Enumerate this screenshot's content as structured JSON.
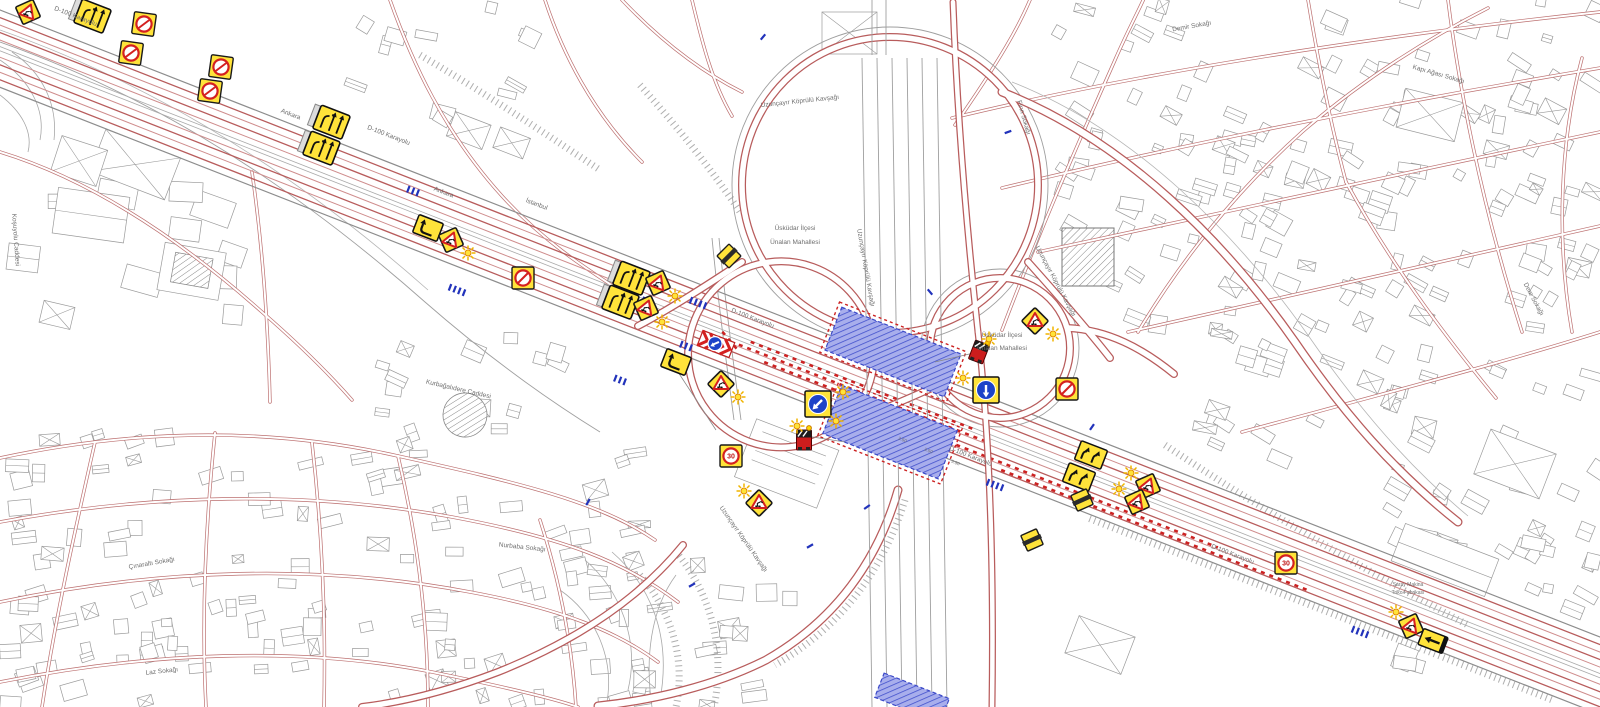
{
  "map": {
    "colors": {
      "sign_yellow": "#ffe33a",
      "work_zone_blue": "#8e97e8",
      "cone_red": "#cc2222",
      "road_red": "#b85c5c",
      "mandatory_blue": "#1d43c8",
      "building_gray": "#9a9a9a"
    },
    "labels": [
      {
        "text": "D-100 Karayolu",
        "x": 75,
        "y": 18,
        "r": 21
      },
      {
        "text": "Ankara",
        "x": 290,
        "y": 116,
        "r": 21
      },
      {
        "text": "D-100 Karayolu",
        "x": 388,
        "y": 137,
        "r": 21
      },
      {
        "text": "Ankara",
        "x": 443,
        "y": 194,
        "r": 21
      },
      {
        "text": "İstanbul",
        "x": 536,
        "y": 206,
        "r": 21
      },
      {
        "text": "D-100 Karayolu",
        "x": 752,
        "y": 320,
        "r": 21
      },
      {
        "text": "D-100 Karayolu",
        "x": 970,
        "y": 458,
        "r": 21
      },
      {
        "text": "D-100 Karayolu",
        "x": 1232,
        "y": 556,
        "r": 21
      },
      {
        "text": "Uzunçayır Köprülü Kavşağı",
        "x": 800,
        "y": 103,
        "r": -6
      },
      {
        "text": "Üsküdar İlçesi",
        "x": 795,
        "y": 230,
        "r": 0
      },
      {
        "text": "Ünalan Mahallesi",
        "x": 795,
        "y": 244,
        "r": 0
      },
      {
        "text": "Üsküdar İlçesi",
        "x": 1002,
        "y": 337,
        "r": 0
      },
      {
        "text": "Ünalan Mahallesi",
        "x": 1002,
        "y": 350,
        "r": 0
      },
      {
        "text": "Uzunçayır Köprülü Kavşağı",
        "x": 864,
        "y": 268,
        "r": 80
      },
      {
        "text": "Uzunçayır Köprülü Kavşağı",
        "x": 1054,
        "y": 282,
        "r": 62
      },
      {
        "text": "Uzunçayır Köprülü Kavşağı",
        "x": 742,
        "y": 540,
        "r": 55
      },
      {
        "text": "Kurbağalıdere Caddesi",
        "x": 458,
        "y": 391,
        "r": 13
      },
      {
        "text": "Çınaraltı Sokağı",
        "x": 152,
        "y": 565,
        "r": -10
      },
      {
        "text": "Nurbaba Sokağı",
        "x": 522,
        "y": 549,
        "r": 6
      },
      {
        "text": "Laz Sokağı",
        "x": 162,
        "y": 673,
        "r": -6
      },
      {
        "text": "Koşuyolu Caddesi",
        "x": 14,
        "y": 240,
        "r": 86
      },
      {
        "text": "Demir Sokağı",
        "x": 1192,
        "y": 28,
        "r": -10
      },
      {
        "text": "Fırın Sokağı",
        "x": 1022,
        "y": 118,
        "r": 74
      },
      {
        "text": "Kapı Ağası Sokağı",
        "x": 1438,
        "y": 76,
        "r": 16
      },
      {
        "text": "Dere Sokağı",
        "x": 1532,
        "y": 300,
        "r": 62
      },
      {
        "text": "Saray Makina",
        "x": 1408,
        "y": 586,
        "r": 0,
        "s": 5
      },
      {
        "text": "Triko Fabrikası",
        "x": 1408,
        "y": 594,
        "r": 0,
        "s": 5
      },
      {
        "text": "3.50",
        "x": 902,
        "y": 441,
        "r": 21,
        "s": 4.5
      },
      {
        "text": "3.50",
        "x": 928,
        "y": 452,
        "r": 21,
        "s": 4.5
      },
      {
        "text": "3.50",
        "x": 955,
        "y": 464,
        "r": 21,
        "s": 4.5
      }
    ],
    "devices": [
      {
        "t": "rw",
        "name": "roadwork-warning-sign",
        "x": 28,
        "y": 12,
        "r": 21
      },
      {
        "t": "laneboard",
        "name": "lane-closure-board",
        "x": 92,
        "y": 16,
        "r": 21
      },
      {
        "t": "nostop",
        "name": "no-stopping-sign",
        "x": 144,
        "y": 24,
        "r": 8
      },
      {
        "t": "nostop",
        "name": "no-stopping-sign",
        "x": 131,
        "y": 53,
        "r": 8
      },
      {
        "t": "nostop",
        "name": "no-stopping-sign",
        "x": 221,
        "y": 67,
        "r": 8
      },
      {
        "t": "nostop",
        "name": "no-stopping-sign",
        "x": 210,
        "y": 91,
        "r": 8
      },
      {
        "t": "laneboard",
        "name": "lane-closure-board",
        "x": 331,
        "y": 122,
        "r": 21
      },
      {
        "t": "laneboard",
        "name": "lane-closure-board",
        "x": 321,
        "y": 148,
        "r": 21
      },
      {
        "t": "shift",
        "name": "lane-shift-sign",
        "x": 428,
        "y": 228,
        "r": 21
      },
      {
        "t": "rw",
        "name": "roadwork-warning-sign",
        "x": 451,
        "y": 240,
        "r": 21
      },
      {
        "t": "flash",
        "name": "warning-flasher",
        "x": 468,
        "y": 253
      },
      {
        "t": "nostop",
        "name": "no-stopping-sign",
        "x": 523,
        "y": 278,
        "r": 0
      },
      {
        "t": "laneboard",
        "name": "lane-closure-board",
        "x": 631,
        "y": 278,
        "r": 21
      },
      {
        "t": "laneboard",
        "name": "lane-closure-board",
        "x": 620,
        "y": 302,
        "r": 21
      },
      {
        "t": "rw",
        "name": "roadwork-warning-sign",
        "x": 658,
        "y": 283,
        "r": 21
      },
      {
        "t": "flash",
        "name": "warning-flasher",
        "x": 675,
        "y": 296
      },
      {
        "t": "rw",
        "name": "roadwork-warning-sign",
        "x": 646,
        "y": 308,
        "r": 21
      },
      {
        "t": "flash",
        "name": "warning-flasher",
        "x": 662,
        "y": 322
      },
      {
        "t": "slash",
        "name": "end-of-restriction-sign",
        "x": 729,
        "y": 256,
        "r": 0
      },
      {
        "t": "arrowboard",
        "name": "arrow-board-trailer",
        "x": 716,
        "y": 344,
        "r": 21
      },
      {
        "t": "shift",
        "name": "lane-shift-sign",
        "x": 676,
        "y": 362,
        "r": 21
      },
      {
        "t": "rw",
        "name": "roadwork-warning-sign",
        "x": 721,
        "y": 384,
        "r": 0
      },
      {
        "t": "flash",
        "name": "warning-flasher",
        "x": 738,
        "y": 397
      },
      {
        "t": "keep",
        "name": "mandatory-direction-sign",
        "x": 818,
        "y": 404,
        "r": 0
      },
      {
        "t": "flash",
        "name": "warning-flasher",
        "x": 843,
        "y": 392
      },
      {
        "t": "flash",
        "name": "warning-flasher",
        "x": 836,
        "y": 421
      },
      {
        "t": "truck",
        "name": "maintenance-truck",
        "x": 804,
        "y": 440,
        "r": 0
      },
      {
        "t": "flash",
        "name": "warning-flasher",
        "x": 797,
        "y": 426
      },
      {
        "t": "spd",
        "name": "speed-limit-sign",
        "x": 731,
        "y": 456,
        "r": 0,
        "label": "30"
      },
      {
        "t": "rw",
        "name": "roadwork-warning-sign",
        "x": 759,
        "y": 503,
        "r": 0
      },
      {
        "t": "flash",
        "name": "warning-flasher",
        "x": 744,
        "y": 491
      },
      {
        "t": "truck",
        "name": "maintenance-truck",
        "x": 979,
        "y": 352,
        "r": 21
      },
      {
        "t": "flash",
        "name": "warning-flasher",
        "x": 989,
        "y": 339
      },
      {
        "t": "rw",
        "name": "roadwork-warning-sign",
        "x": 1035,
        "y": 321,
        "r": 0
      },
      {
        "t": "flash",
        "name": "warning-flasher",
        "x": 1053,
        "y": 334
      },
      {
        "t": "keepdown",
        "name": "mandatory-direction-sign",
        "x": 986,
        "y": 390,
        "r": 0
      },
      {
        "t": "flash",
        "name": "warning-flasher",
        "x": 963,
        "y": 378
      },
      {
        "t": "nostop",
        "name": "no-stopping-sign",
        "x": 1067,
        "y": 389,
        "r": 0
      },
      {
        "t": "shift2",
        "name": "double-lane-shift-sign",
        "x": 1091,
        "y": 455,
        "r": 21
      },
      {
        "t": "shift2",
        "name": "double-lane-shift-sign",
        "x": 1079,
        "y": 477,
        "r": 21
      },
      {
        "t": "slash",
        "name": "end-of-restriction-sign",
        "x": 1082,
        "y": 500,
        "r": 21
      },
      {
        "t": "slash",
        "name": "end-of-restriction-sign",
        "x": 1032,
        "y": 540,
        "r": 21
      },
      {
        "t": "rw",
        "name": "roadwork-warning-sign",
        "x": 1148,
        "y": 486,
        "r": 21
      },
      {
        "t": "flash",
        "name": "warning-flasher",
        "x": 1131,
        "y": 473
      },
      {
        "t": "rw",
        "name": "roadwork-warning-sign",
        "x": 1137,
        "y": 502,
        "r": 21
      },
      {
        "t": "flash",
        "name": "warning-flasher",
        "x": 1119,
        "y": 489
      },
      {
        "t": "spd",
        "name": "speed-limit-sign",
        "x": 1286,
        "y": 563,
        "r": 0,
        "label": "30"
      },
      {
        "t": "rw",
        "name": "roadwork-warning-sign",
        "x": 1411,
        "y": 626,
        "r": 21
      },
      {
        "t": "flash",
        "name": "warning-flasher",
        "x": 1396,
        "y": 612
      },
      {
        "t": "shiftleft",
        "name": "direction-arrow-sign",
        "x": 1433,
        "y": 641,
        "r": 21
      }
    ],
    "lane_arrow_clusters": [
      {
        "x": 413,
        "y": 191,
        "r": 21,
        "n": 3
      },
      {
        "x": 457,
        "y": 290,
        "r": 21,
        "n": 4
      },
      {
        "x": 698,
        "y": 303,
        "r": 21,
        "n": 4
      },
      {
        "x": 686,
        "y": 346,
        "r": 21,
        "n": 3
      },
      {
        "x": 620,
        "y": 380,
        "r": 21,
        "n": 3
      },
      {
        "x": 995,
        "y": 485,
        "r": 21,
        "n": 4
      },
      {
        "x": 1360,
        "y": 632,
        "r": 21,
        "n": 4
      },
      {
        "x": 763,
        "y": 37,
        "r": 40,
        "n": 1
      },
      {
        "x": 1008,
        "y": 132,
        "r": 70,
        "n": 1
      },
      {
        "x": 643,
        "y": 300,
        "r": 21,
        "n": 1
      },
      {
        "x": 930,
        "y": 292,
        "r": -40,
        "n": 1
      },
      {
        "x": 1092,
        "y": 427,
        "r": 35,
        "n": 1
      },
      {
        "x": 810,
        "y": 546,
        "r": 60,
        "n": 1
      },
      {
        "x": 867,
        "y": 507,
        "r": 55,
        "n": 1
      },
      {
        "x": 588,
        "y": 502,
        "r": 30,
        "n": 1
      },
      {
        "x": 692,
        "y": 585,
        "r": 60,
        "n": 1
      }
    ]
  }
}
